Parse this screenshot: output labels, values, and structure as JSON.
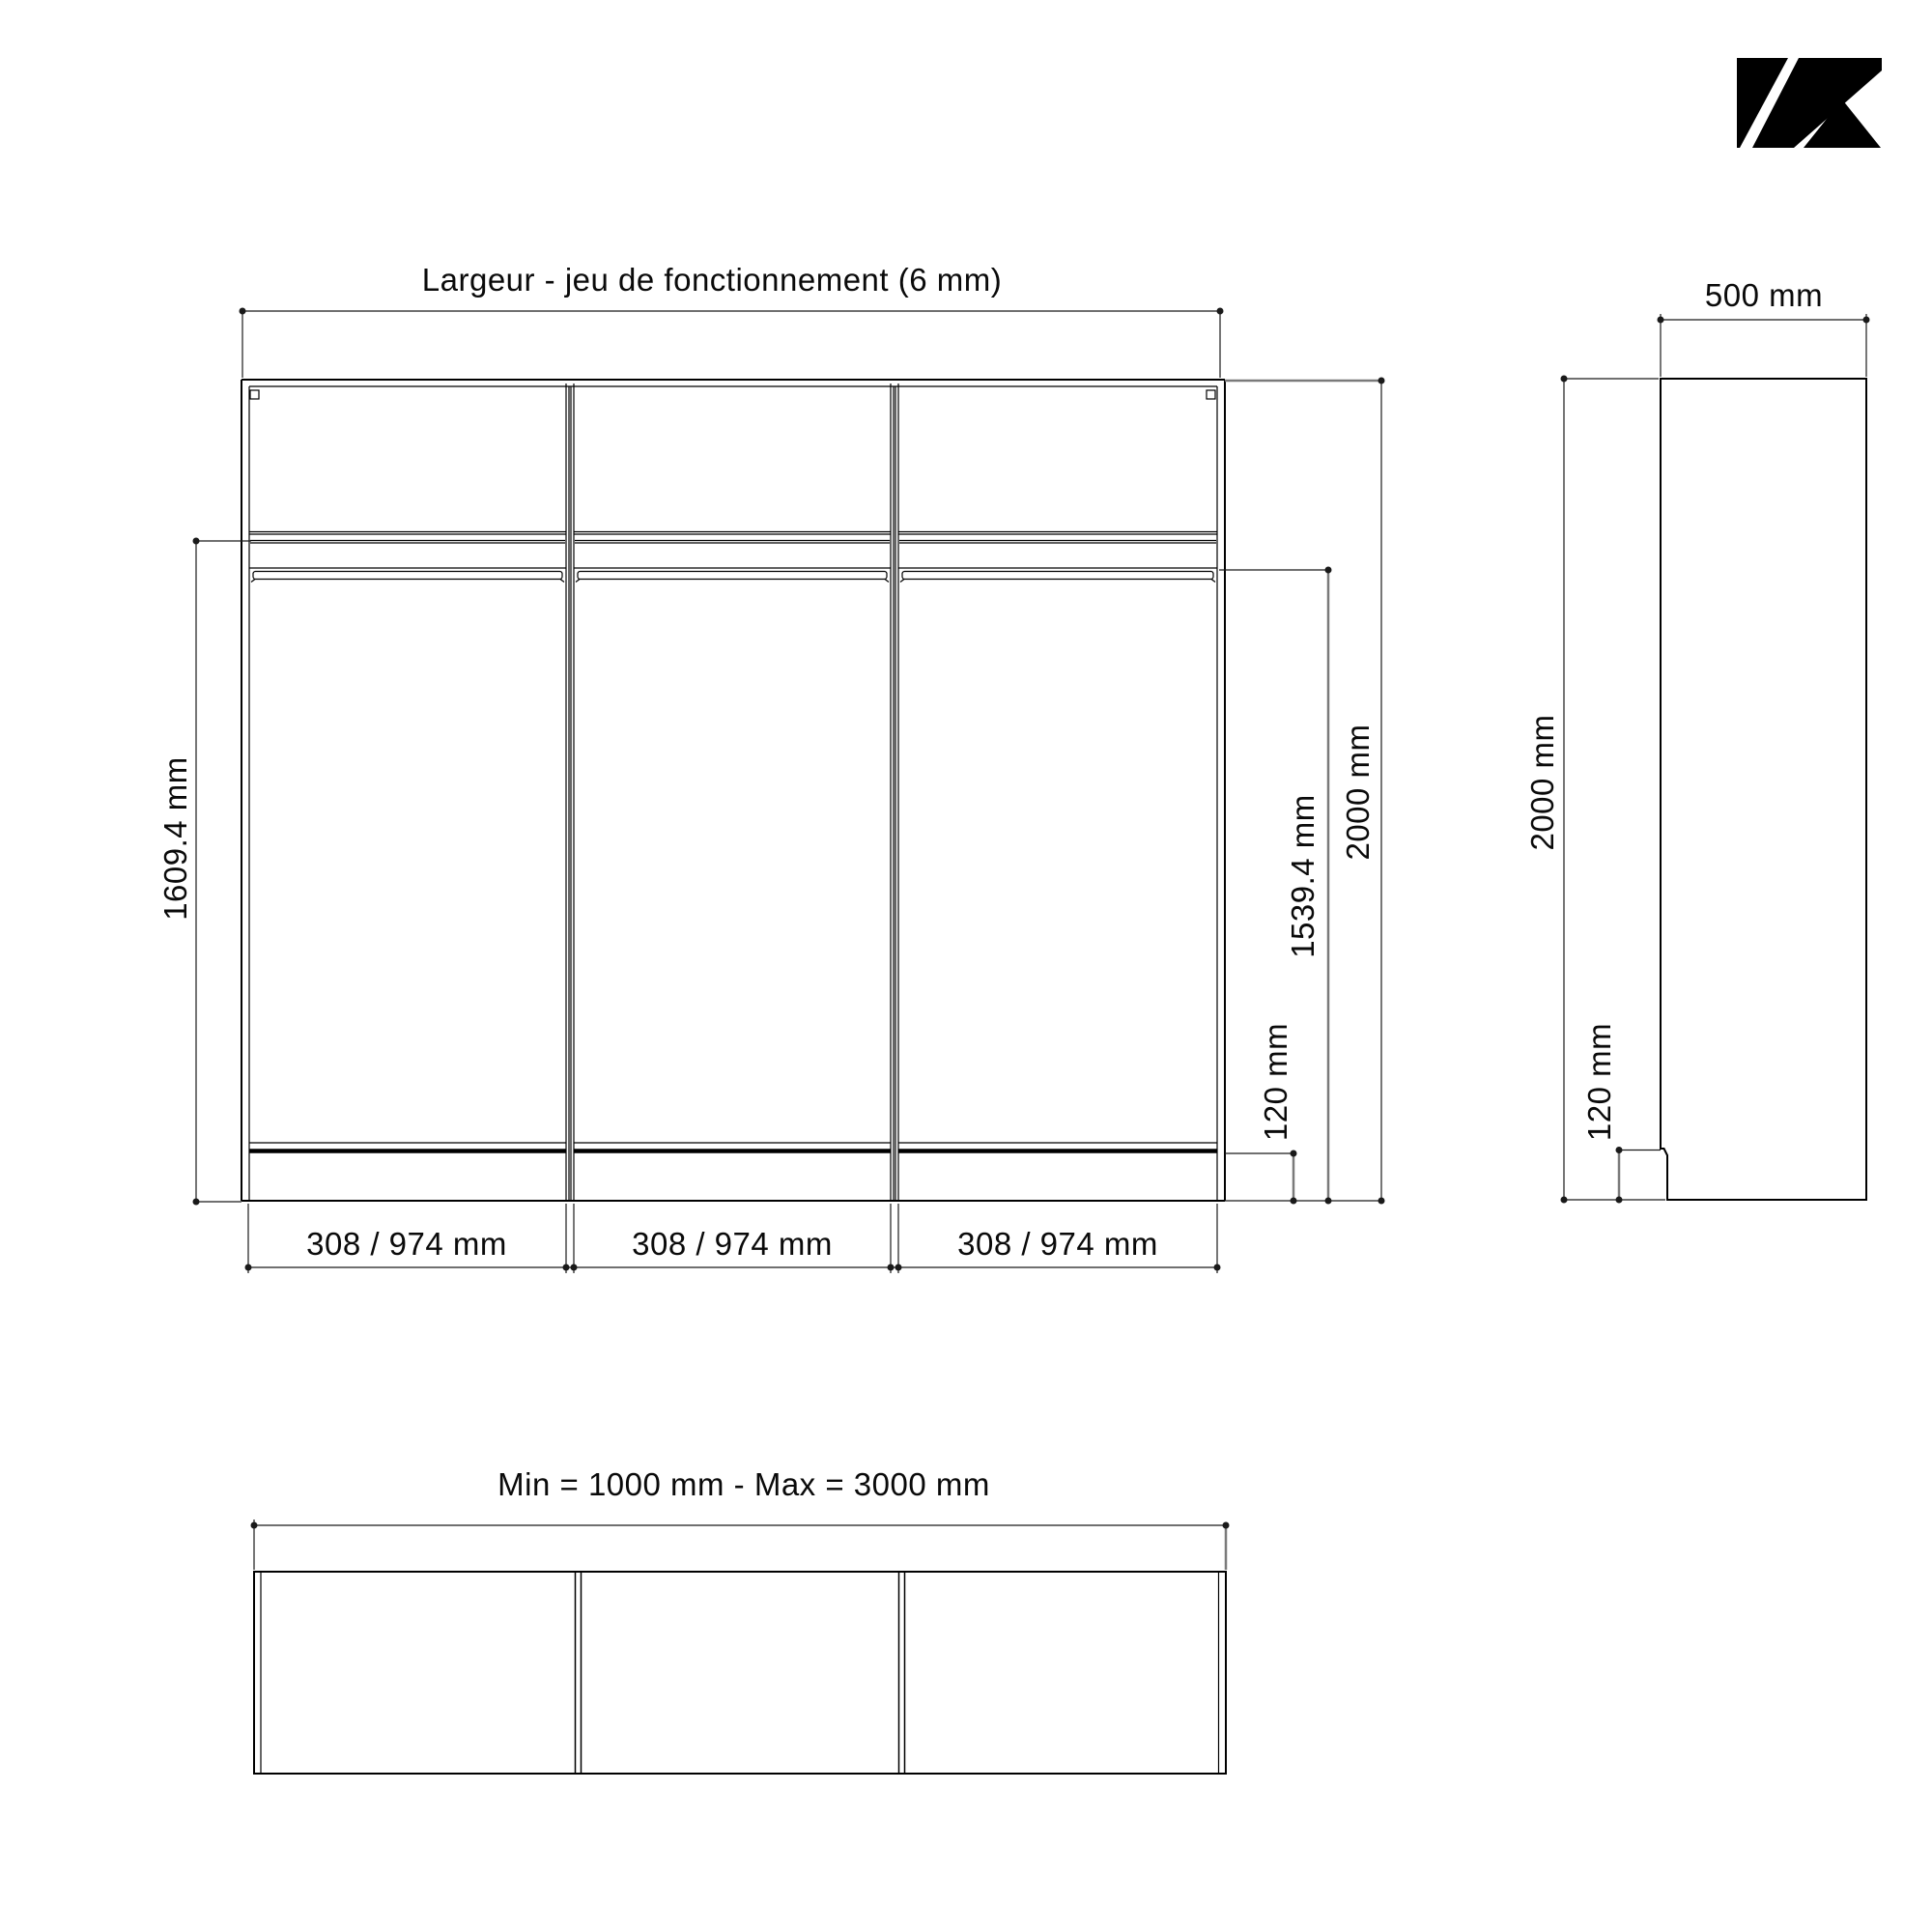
{
  "page": {
    "background": "#ffffff",
    "line_color": "#000000",
    "dim_line_gray": "#7a7a7a"
  },
  "logo": {
    "description": "black-diagonal-stripes-mark",
    "color": "#000000"
  },
  "front_view": {
    "title": "Largeur - jeu de fonctionnement (6 mm)",
    "total_height": "2000 mm",
    "interior_height": "1609.4 mm",
    "under_rail_height": "1539.4 mm",
    "plinth_height": "120 mm",
    "bay_width": "308 / 974 mm"
  },
  "side_view": {
    "depth": "500 mm",
    "total_height": "2000 mm",
    "plinth_height": "120 mm"
  },
  "bottom_view": {
    "width_range": "Min = 1000 mm - Max = 3000 mm"
  }
}
